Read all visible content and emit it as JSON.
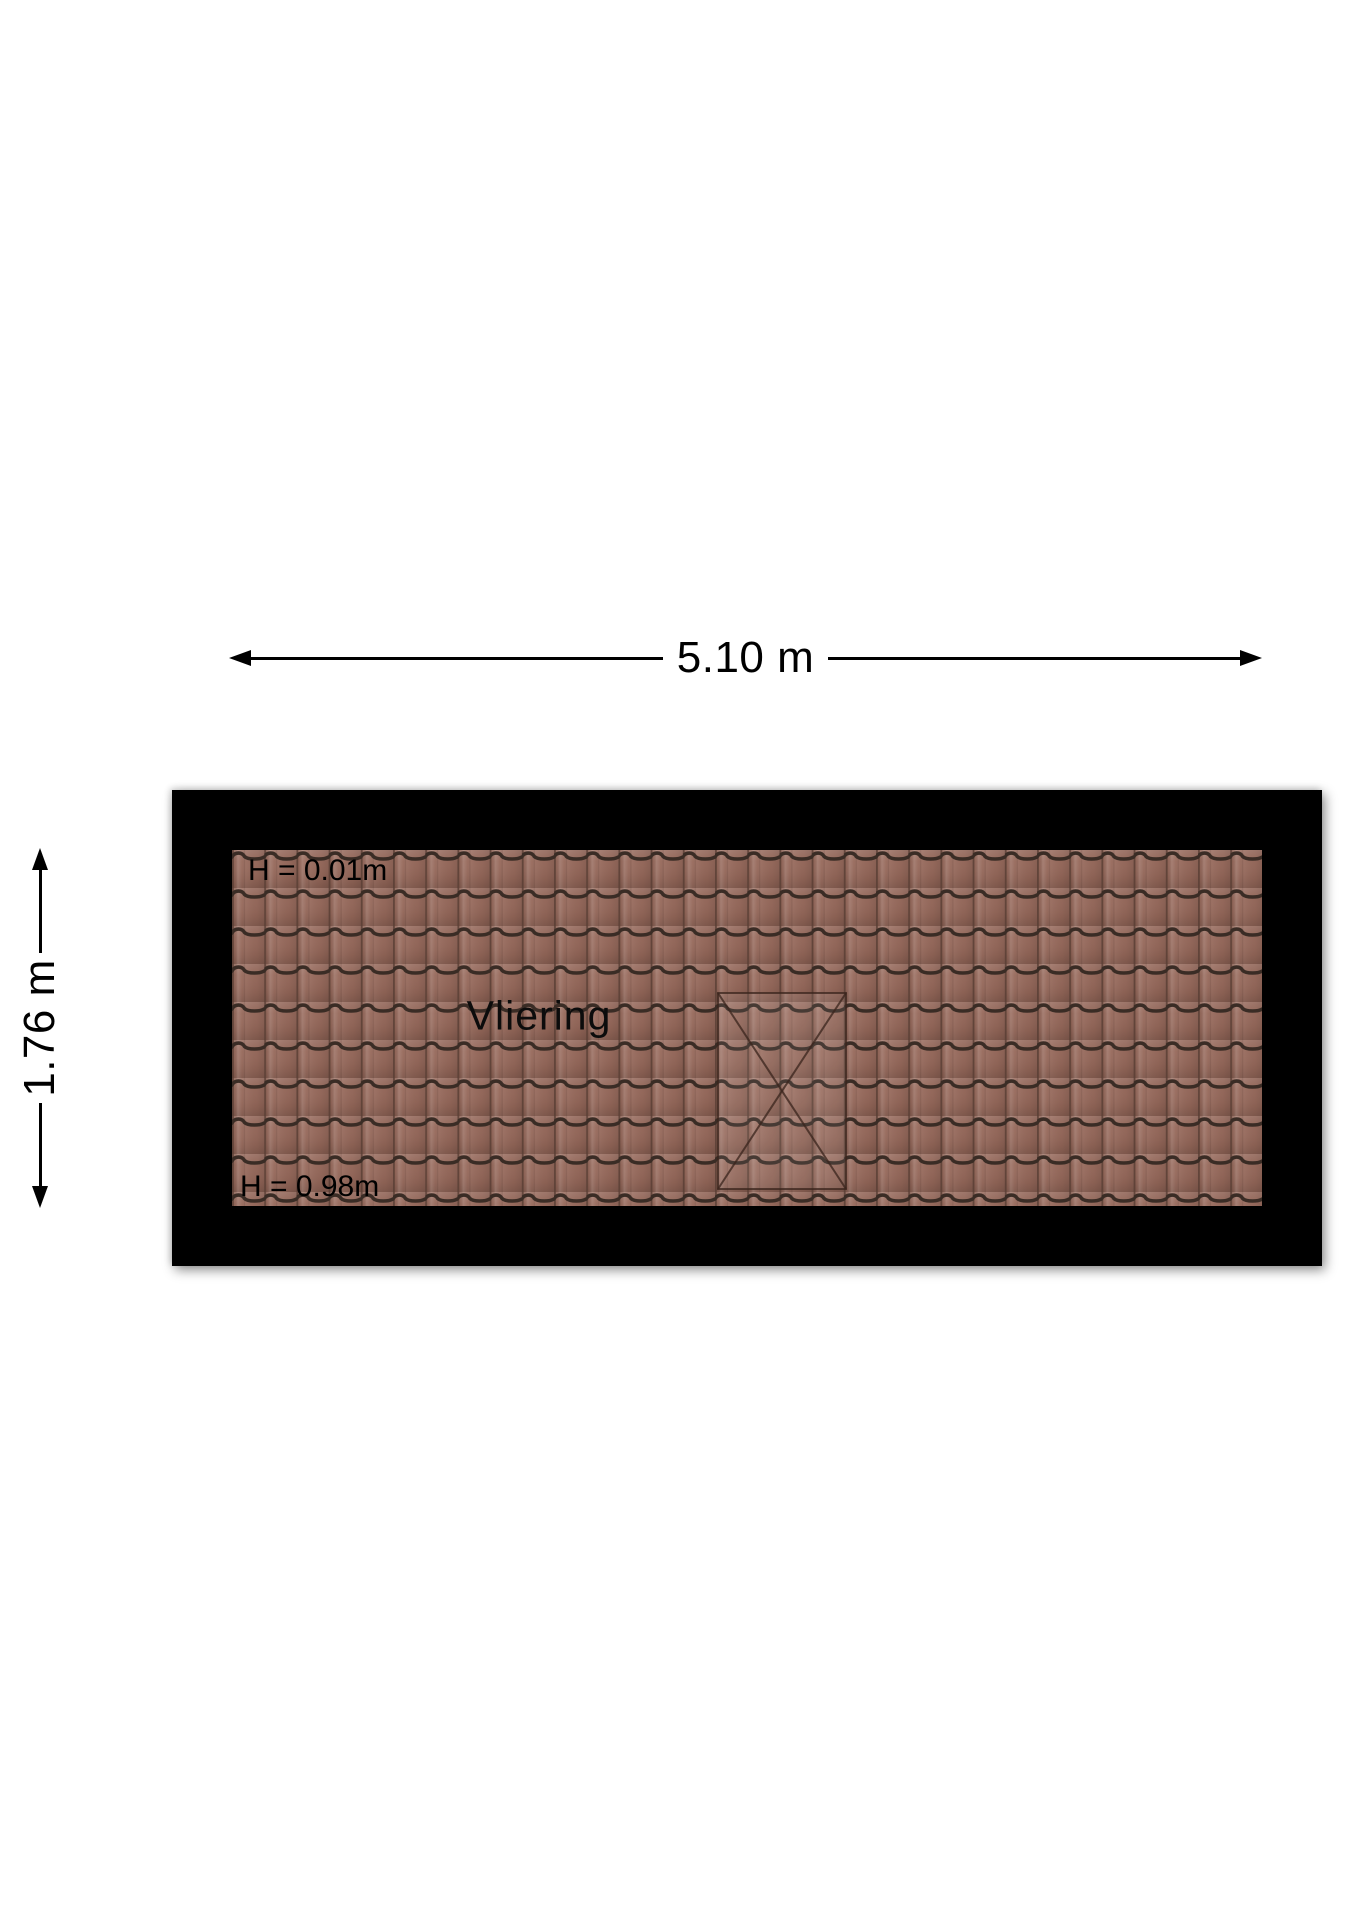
{
  "dimensions": {
    "width_label": "5.10 m",
    "height_label": "1.76 m"
  },
  "room": {
    "name": "Vliering",
    "height_top": "H = 0.01m",
    "height_bottom": "H = 0.98m"
  },
  "colors": {
    "background": "#ffffff",
    "wall": "#000000",
    "text": "#000000",
    "tile_base": "#96685a",
    "tile_line": "#3a2c25",
    "tile_seam": "#5d4136",
    "skylight_line": "#3a241c"
  }
}
